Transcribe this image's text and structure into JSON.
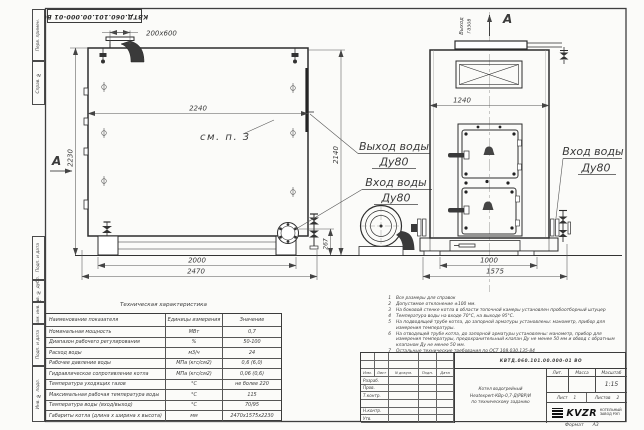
{
  "frame": {
    "top_stamp": "КВТД.060.101.00.000-01 ВО",
    "margin_labels": [
      "Перв. примен.",
      "Справ. №",
      "Подп. и дата",
      "Инв. № дубл.",
      "Взам. инв. №",
      "Подп. и дата",
      "Инв. № подл."
    ],
    "format_label": "Формат",
    "format_value": "А3"
  },
  "side_view": {
    "section_label": "А",
    "see_note": "см. п. 3",
    "dims": {
      "duct": "200х600",
      "width": "2240",
      "height_left": "2230",
      "height_right": "2140",
      "flange_height": "267",
      "legs_span": "2000",
      "total_length": "2470"
    }
  },
  "front_view": {
    "view_label": "А",
    "gas_out_word1": "Выход",
    "gas_out_word2": "газов",
    "dims": {
      "width": "1240",
      "base": "1000",
      "total_width": "1575"
    }
  },
  "pipe_labels": {
    "out1": "Выход воды",
    "out2": "Ду80",
    "in1": "Вход воды",
    "in2": "Ду80",
    "in_right1": "Вход воды",
    "in_right2": "Ду80"
  },
  "notes": {
    "items": [
      {
        "num": "1",
        "text": "Все размеры для справок"
      },
      {
        "num": "2",
        "text": "Допустимое отклонение ±100 мм."
      },
      {
        "num": "3",
        "text": "На боковой стенке котла в области топочной камеры установлен пробоотборный штуцер"
      },
      {
        "num": "4",
        "text": "Температура воды на входе 70°С, на выходе 95°С."
      },
      {
        "num": "5",
        "text": "На подводящей трубе котла, до запорной арматуры установлены: манометр, прибор для измерения температуры."
      },
      {
        "num": "6",
        "text": "На отводящей трубе котла, до запорной арматуры установлены: манометр, прибор для измерения температуры, предохранительный клапан Ду не менее 50 мм и обвод с обратным клапаном Ду не менее 50 мм."
      },
      {
        "num": "7",
        "text": "Остальные технические требования по ОСТ 108.030.135-84"
      }
    ]
  },
  "tech_table": {
    "title": "Техническая характеристика",
    "headers": [
      "Наименование показателя",
      "Единицы измерения",
      "Значение"
    ],
    "rows": [
      [
        "Номинальная мощность",
        "МВт",
        "0,7"
      ],
      [
        "Диапазон рабочего регулирования",
        "%",
        "50-100"
      ],
      [
        "Расход воды",
        "м3/ч",
        "24"
      ],
      [
        "Рабочее давление воды",
        "МПа (кгс/см2)",
        "0,6 (6,0)"
      ],
      [
        "Гидравлическое сопротивление котла",
        "МПа (кгс/см2)",
        "0,06 (0,6)"
      ],
      [
        "Температура уходящих газов",
        "°С",
        "не более 220"
      ],
      [
        "Максимальная рабочая температура воды",
        "°С",
        "115"
      ],
      [
        "Температура воды (вход/выход)",
        "°С",
        "70/95"
      ],
      [
        "Габариты котла (длина х ширина х высота)",
        "мм",
        "2470х1575х2230"
      ]
    ]
  },
  "title_block": {
    "designation": "КВТД.060.101.00.000-01 ВО",
    "product_line1": "Котел водогрейный",
    "product_line2": "Heatexpert-КВр-0,7-Д(РВР)И",
    "product_line3": "по техническому заданию",
    "change_header": [
      "Изм.",
      "Лист",
      "N докум.",
      "Подп.",
      "Дата"
    ],
    "roles": [
      "Разраб.",
      "Пров.",
      "Т.контр.",
      "",
      "Н.контр.",
      "Утв."
    ],
    "lit_label": "Лит.",
    "mass_label": "Масса",
    "scale_label": "Масштаб",
    "scale_value": "1:15",
    "sheet_label": "Лист",
    "sheet_value": "1",
    "sheets_label": "Листов",
    "sheets_value": "2",
    "logo_text": "KVZR",
    "company_line1": "КОТЕЛЬНЫЙ",
    "company_line2": "ЗАВОД РЭП"
  }
}
